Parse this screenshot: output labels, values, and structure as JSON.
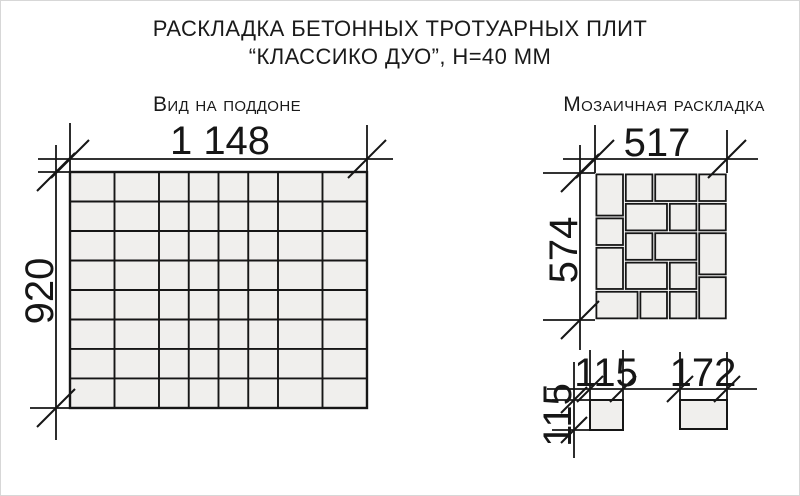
{
  "title": {
    "line1": "РАСКЛАДКА БЕТОННЫХ ТРОТУАРНЫХ ПЛИТ",
    "line2": "“КЛАССИКО ДУО”, Н=40 ММ"
  },
  "pallet_view": {
    "label": "Вид на поддоне",
    "width_label": "1 148",
    "height_label": "920",
    "columns_mm": [
      172,
      172,
      115,
      115,
      115,
      115,
      172,
      172
    ],
    "rows": 8,
    "row_height_mm": 115
  },
  "mosaic_view": {
    "label": "Мозаичная раскладка",
    "width_label": "517",
    "height_label": "574",
    "tiles_mm": [
      {
        "x": 0,
        "y": 0,
        "w": 115,
        "h": 172
      },
      {
        "x": 115,
        "y": 0,
        "w": 115,
        "h": 115
      },
      {
        "x": 230,
        "y": 0,
        "w": 172,
        "h": 115
      },
      {
        "x": 402,
        "y": 0,
        "w": 115,
        "h": 115
      },
      {
        "x": 115,
        "y": 115,
        "w": 172,
        "h": 115
      },
      {
        "x": 287,
        "y": 115,
        "w": 115,
        "h": 115
      },
      {
        "x": 402,
        "y": 115,
        "w": 115,
        "h": 115
      },
      {
        "x": 0,
        "y": 172,
        "w": 115,
        "h": 115
      },
      {
        "x": 115,
        "y": 230,
        "w": 115,
        "h": 115
      },
      {
        "x": 230,
        "y": 230,
        "w": 172,
        "h": 115
      },
      {
        "x": 402,
        "y": 230,
        "w": 115,
        "h": 172
      },
      {
        "x": 0,
        "y": 287,
        "w": 115,
        "h": 172
      },
      {
        "x": 115,
        "y": 345,
        "w": 172,
        "h": 114
      },
      {
        "x": 287,
        "y": 345,
        "w": 115,
        "h": 114
      },
      {
        "x": 402,
        "y": 402,
        "w": 115,
        "h": 172
      },
      {
        "x": 0,
        "y": 459,
        "w": 172,
        "h": 115
      },
      {
        "x": 172,
        "y": 459,
        "w": 115,
        "h": 115
      },
      {
        "x": 287,
        "y": 459,
        "w": 115,
        "h": 115
      }
    ]
  },
  "single_tiles": {
    "square": {
      "width_label": "115",
      "height_label": "115",
      "w_mm": 115,
      "h_mm": 115
    },
    "rect": {
      "width_label": "172",
      "w_mm": 172,
      "h_mm": 115
    }
  },
  "colors": {
    "line": "#161616",
    "tile_fill": "#f0efed",
    "background": "#ffffff"
  }
}
